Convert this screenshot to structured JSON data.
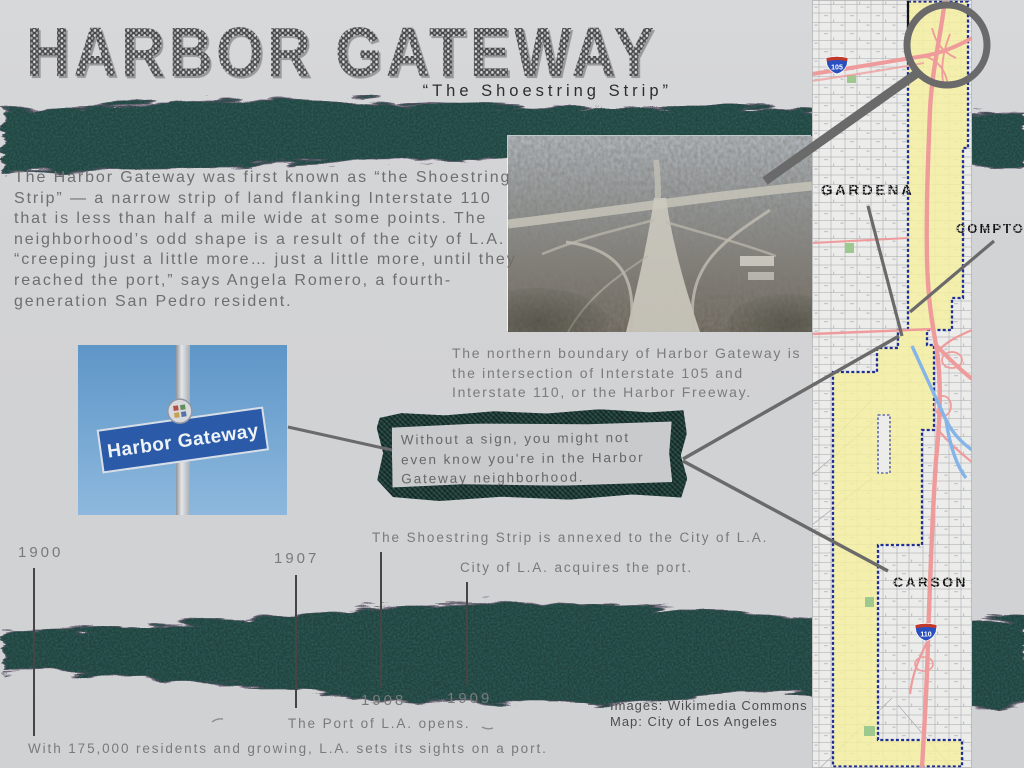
{
  "page": {
    "title": "HARBOR GATEWAY",
    "subtitle": "“The Shoestring Strip”"
  },
  "intro": "The Harbor Gateway was first known as “the Shoestring Strip” — a narrow strip of land flanking Interstate 110 that is less than half a mile wide at some points. The neighborhood’s odd shape is a result of the city of L.A. “creeping just a little more… just a little more, until they reached the port,” says Angela Romero, a fourth-generation San Pedro resident.",
  "boundary_note_lines": [
    "The northern boundary of Harbor Gateway is",
    "the intersection of Interstate 105 and",
    "Interstate 110, or the Harbor Freeway."
  ],
  "sign_caption_lines": [
    "Without a sign, you might not",
    "even know you're in the Harbor",
    "Gateway neighborhood."
  ],
  "sign_photo": {
    "street_sign_text": "Harbor Gateway"
  },
  "map": {
    "city_labels": {
      "gardena": "GARDENA",
      "compton": "COMPTON",
      "carson": "CARSON"
    },
    "highway_shields": {
      "i105": "105",
      "i110": "110"
    }
  },
  "timeline": {
    "events": [
      {
        "year": "1900",
        "label": "With 175,000 residents and growing, L.A. sets its sights on a port."
      },
      {
        "year": "1907",
        "label": "The Port of L.A. opens."
      },
      {
        "year": "1908",
        "label": "The Shoestring Strip is annexed to the City of L.A."
      },
      {
        "year": "1909",
        "label": "City of L.A. acquires the port."
      }
    ]
  },
  "credits": {
    "images": "Images: Wikimedia Commons",
    "map": "Map: City of Los Angeles"
  },
  "colors": {
    "band": "#24443f",
    "accent_line": "#6a6a6a",
    "neighborhood_fill": "#f6f09e",
    "boundary_blue": "#1d2f96",
    "freeway_pink": "#ef9b9b",
    "sign_blue": "#2b5ba8"
  }
}
